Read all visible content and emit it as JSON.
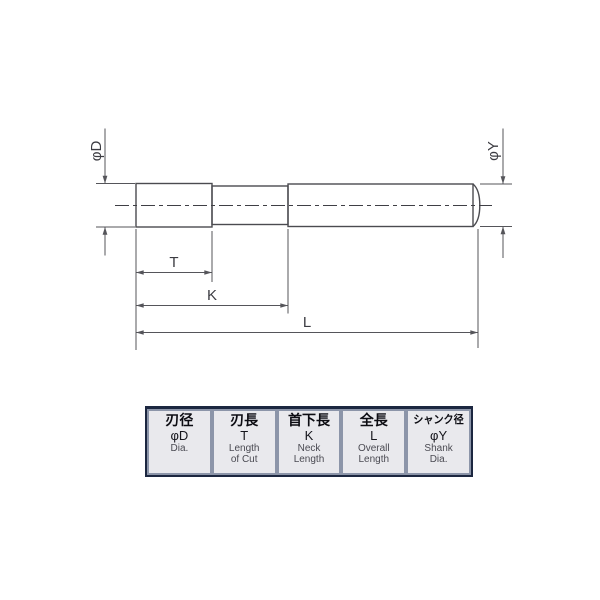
{
  "drawing": {
    "dim_labels": {
      "cut_dia": "φD",
      "shank_dia": "φY",
      "cut_length": "T",
      "neck_length": "K",
      "overall_length": "L"
    },
    "colors": {
      "outline": "#4b4b50",
      "cut_section_fill": "#c9c9cd",
      "dimension_line": "#55555a"
    }
  },
  "spec_table": {
    "colors": {
      "frame": "#1c2740",
      "gutter": "#8c95a9",
      "cell_bg": "#e9e9ed",
      "jp_text": "#0c0c12",
      "en_text": "#4a4a52"
    },
    "columns": [
      {
        "jp": "刃径",
        "symbol": "φD",
        "en1": "Dia.",
        "en2": ""
      },
      {
        "jp": "刃長",
        "symbol": "T",
        "en1": "Length",
        "en2": "of Cut"
      },
      {
        "jp": "首下長",
        "symbol": "K",
        "en1": "Neck",
        "en2": "Length"
      },
      {
        "jp": "全長",
        "symbol": "L",
        "en1": "Overall",
        "en2": "Length"
      },
      {
        "jp": "シャンク径",
        "symbol": "φY",
        "en1": "Shank",
        "en2": "Dia."
      }
    ]
  }
}
